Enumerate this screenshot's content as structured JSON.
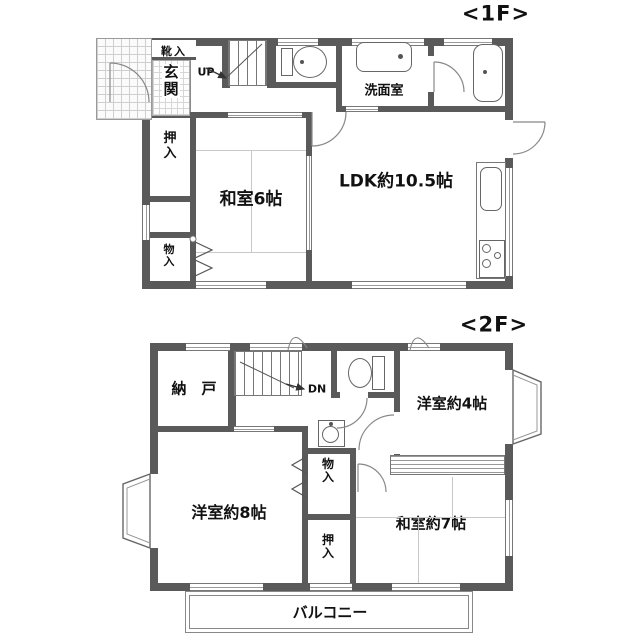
{
  "palette": {
    "wall": "#5a5a5a",
    "line": "#777777",
    "tatami": "#c9c9c9",
    "text": "#111111"
  },
  "floor1": {
    "floor_label": "<1F>",
    "shoe_box": "靴入",
    "entrance": "玄関",
    "stairs": "UP",
    "washroom": "洗面室",
    "oshiire": "押入",
    "washitsu": "和室6帖",
    "ldk": "LDK約10.5帖",
    "monoire": "物入"
  },
  "floor2": {
    "floor_label": "<2F>",
    "nando": "納　戸",
    "stairs": "DN",
    "yoshitsu4": "洋室約4帖",
    "monoire": "物入",
    "yoshitsu8": "洋室約8帖",
    "oshiire": "押入",
    "washitsu7": "和室約7帖",
    "balcony": "バルコニー"
  }
}
